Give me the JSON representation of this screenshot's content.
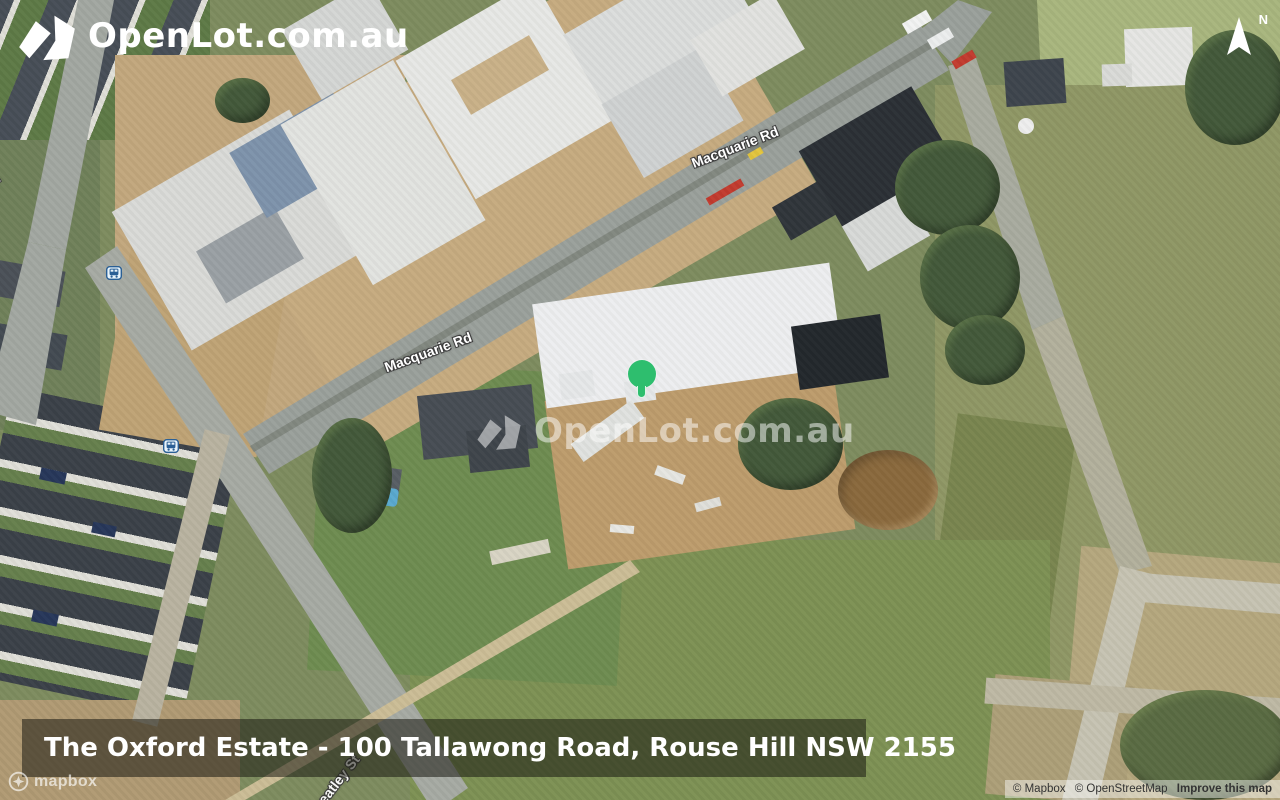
{
  "header": {
    "logo_text": "OpenLot.com.au"
  },
  "compass": {
    "label": "N"
  },
  "watermark": {
    "text": "OpenLot.com.au"
  },
  "caption": {
    "text": "The Oxford Estate - 100 Tallawong Road, Rouse Hill NSW 2155"
  },
  "road_labels": {
    "tallawong": "Tallawong Rd",
    "macquarie_upper": "Macquarie Rd",
    "macquarie_lower": "Macquarie Rd",
    "wheatley": "Wheatley St"
  },
  "attribution": {
    "wordmark": "mapbox",
    "mapbox": "© Mapbox",
    "osm": "© OpenStreetMap",
    "improve": "Improve this map"
  },
  "icons": {
    "logo_mark": "openlot-logo-mark",
    "north_arrow": "compass-north-arrow",
    "bus_stop": "bus-stop-map-symbol",
    "mapbox_mark": "mapbox-logo-circle",
    "map_pin": "green-location-marker"
  },
  "colors": {
    "marker_green": "#2ebe6e",
    "label_text": "#ffffff",
    "label_halo": "#3d3d3d",
    "caption_bg": "rgba(25,25,18,0.55)",
    "attribution_text": "#333333"
  }
}
